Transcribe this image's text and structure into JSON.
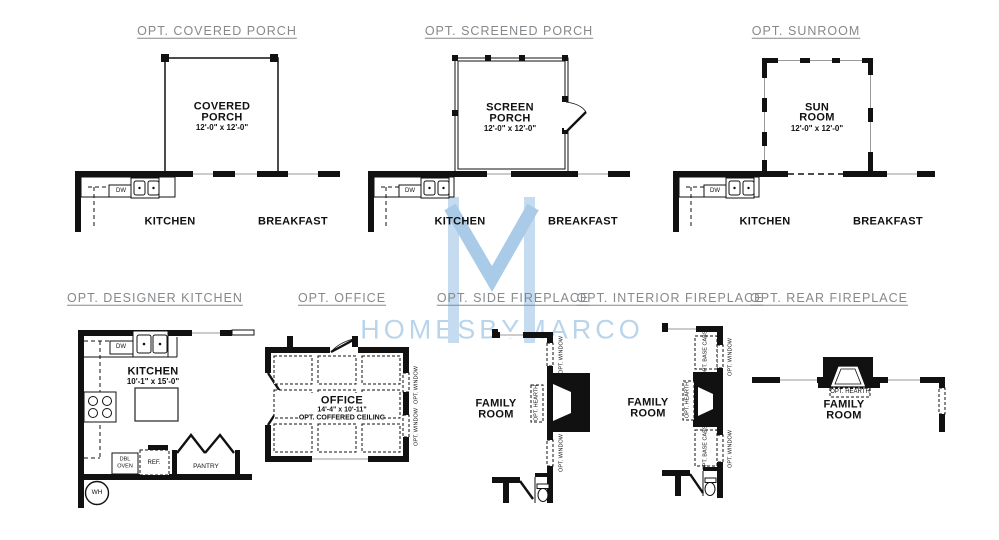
{
  "brand": {
    "wordmark": "HOMESBYMARCO",
    "logo_bar_color": "#c5dbef",
    "logo_v_color": "#a9cbe8",
    "wordmark_color": "#b9d5ec",
    "title_color": "#85898c",
    "line_color": "#111111"
  },
  "panels": {
    "covered_porch": {
      "title": "OPT. COVERED PORCH",
      "room": [
        "COVERED",
        "PORCH"
      ],
      "dims": "12'-0\" x 12'-0\"",
      "kitchen": "KITCHEN",
      "breakfast": "BREAKFAST",
      "dw": "DW"
    },
    "screened_porch": {
      "title": "OPT. SCREENED PORCH",
      "room": [
        "SCREEN",
        "PORCH"
      ],
      "dims": "12'-0\" x 12'-0\"",
      "kitchen": "KITCHEN",
      "breakfast": "BREAKFAST",
      "dw": "DW"
    },
    "sunroom": {
      "title": "OPT. SUNROOM",
      "room": [
        "SUN",
        "ROOM"
      ],
      "dims": "12'-0\" x 12'-0\"",
      "kitchen": "KITCHEN",
      "breakfast": "BREAKFAST",
      "dw": "DW"
    },
    "designer_kitchen": {
      "title": "OPT. DESIGNER KITCHEN",
      "room": "KITCHEN",
      "dims": "10'-1\" x 15'-0\"",
      "dw": "DW",
      "dbl_oven": [
        "DBL",
        "OVEN"
      ],
      "ref": "REF.",
      "pantry": "PANTRY",
      "wh": "WH"
    },
    "office": {
      "title": "OPT. OFFICE",
      "room": "OFFICE",
      "dims": "14'-4\" x 10'-11\"",
      "ceiling_note": "OPT. COFFERED CEILING",
      "opt_window": "OPT. WINDOW"
    },
    "side_fireplace": {
      "title": "OPT. SIDE FIREPLACE",
      "room": [
        "FAMILY",
        "ROOM"
      ],
      "opt_window": "OPT. WINDOW",
      "opt_hearth": "OPT. HEARTH"
    },
    "interior_fireplace": {
      "title": "OPT. INTERIOR FIREPLACE",
      "room": [
        "FAMILY",
        "ROOM"
      ],
      "opt_window": "OPT. WINDOW",
      "opt_hearth": "OPT. HEARTH",
      "opt_base_cabs": "OPT. BASE CABS"
    },
    "rear_fireplace": {
      "title": "OPT. REAR FIREPLACE",
      "room": [
        "FAMILY",
        "ROOM"
      ],
      "opt_hearth": "OPT. HEARTH"
    }
  }
}
